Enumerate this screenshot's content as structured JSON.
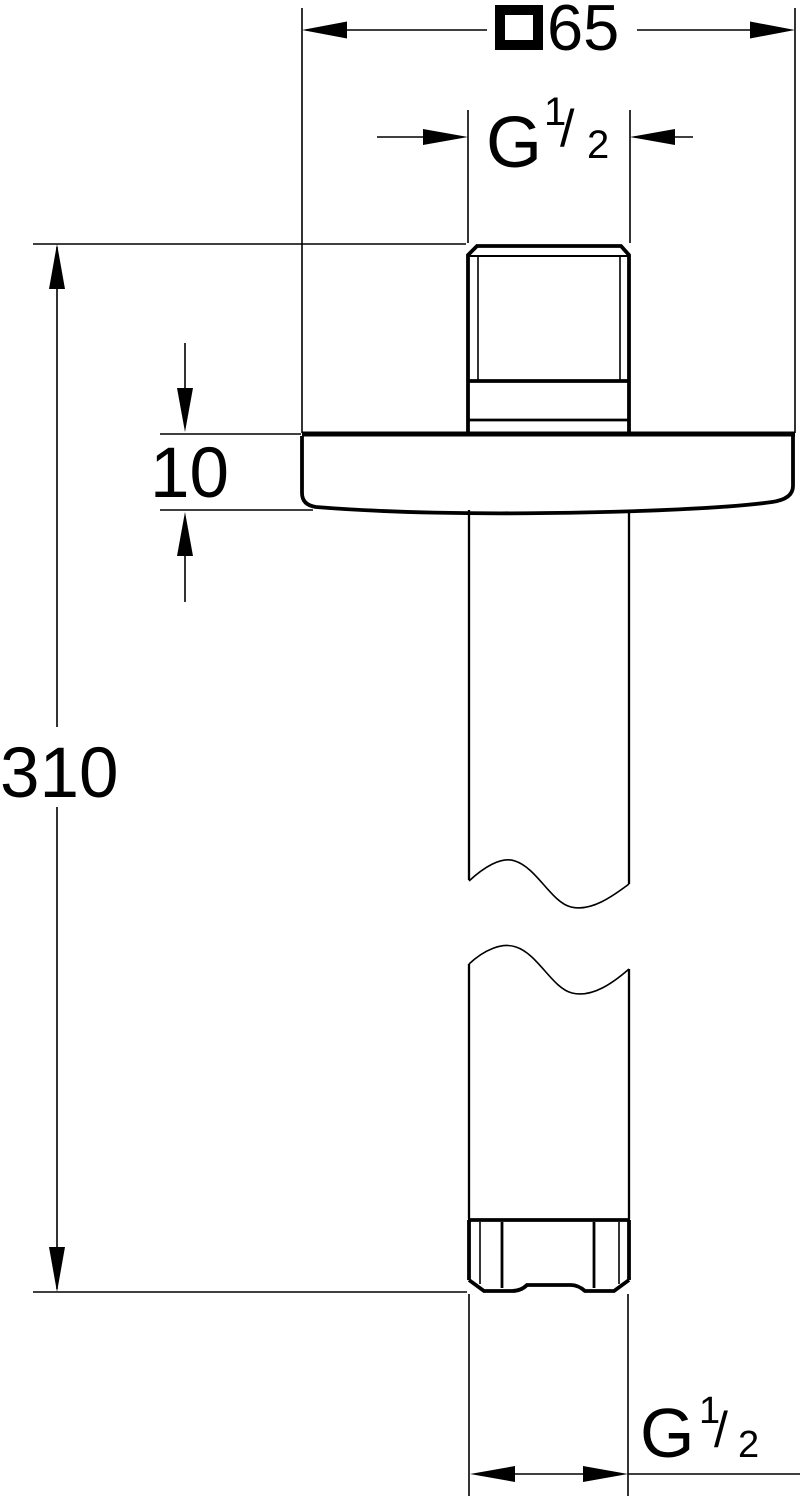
{
  "page": {
    "background": "#ffffff",
    "line_color": "#000000"
  },
  "dimensions": {
    "square_width": {
      "symbol": "□",
      "value": "65"
    },
    "top_thread": {
      "letter": "G",
      "numerator": "1",
      "slash": "/",
      "denominator": "2"
    },
    "flange_thickness": {
      "value": "10"
    },
    "overall_length": {
      "value": "310"
    },
    "bottom_thread": {
      "letter": "G",
      "numerator": "1",
      "slash": "/",
      "denominator": "2"
    }
  }
}
